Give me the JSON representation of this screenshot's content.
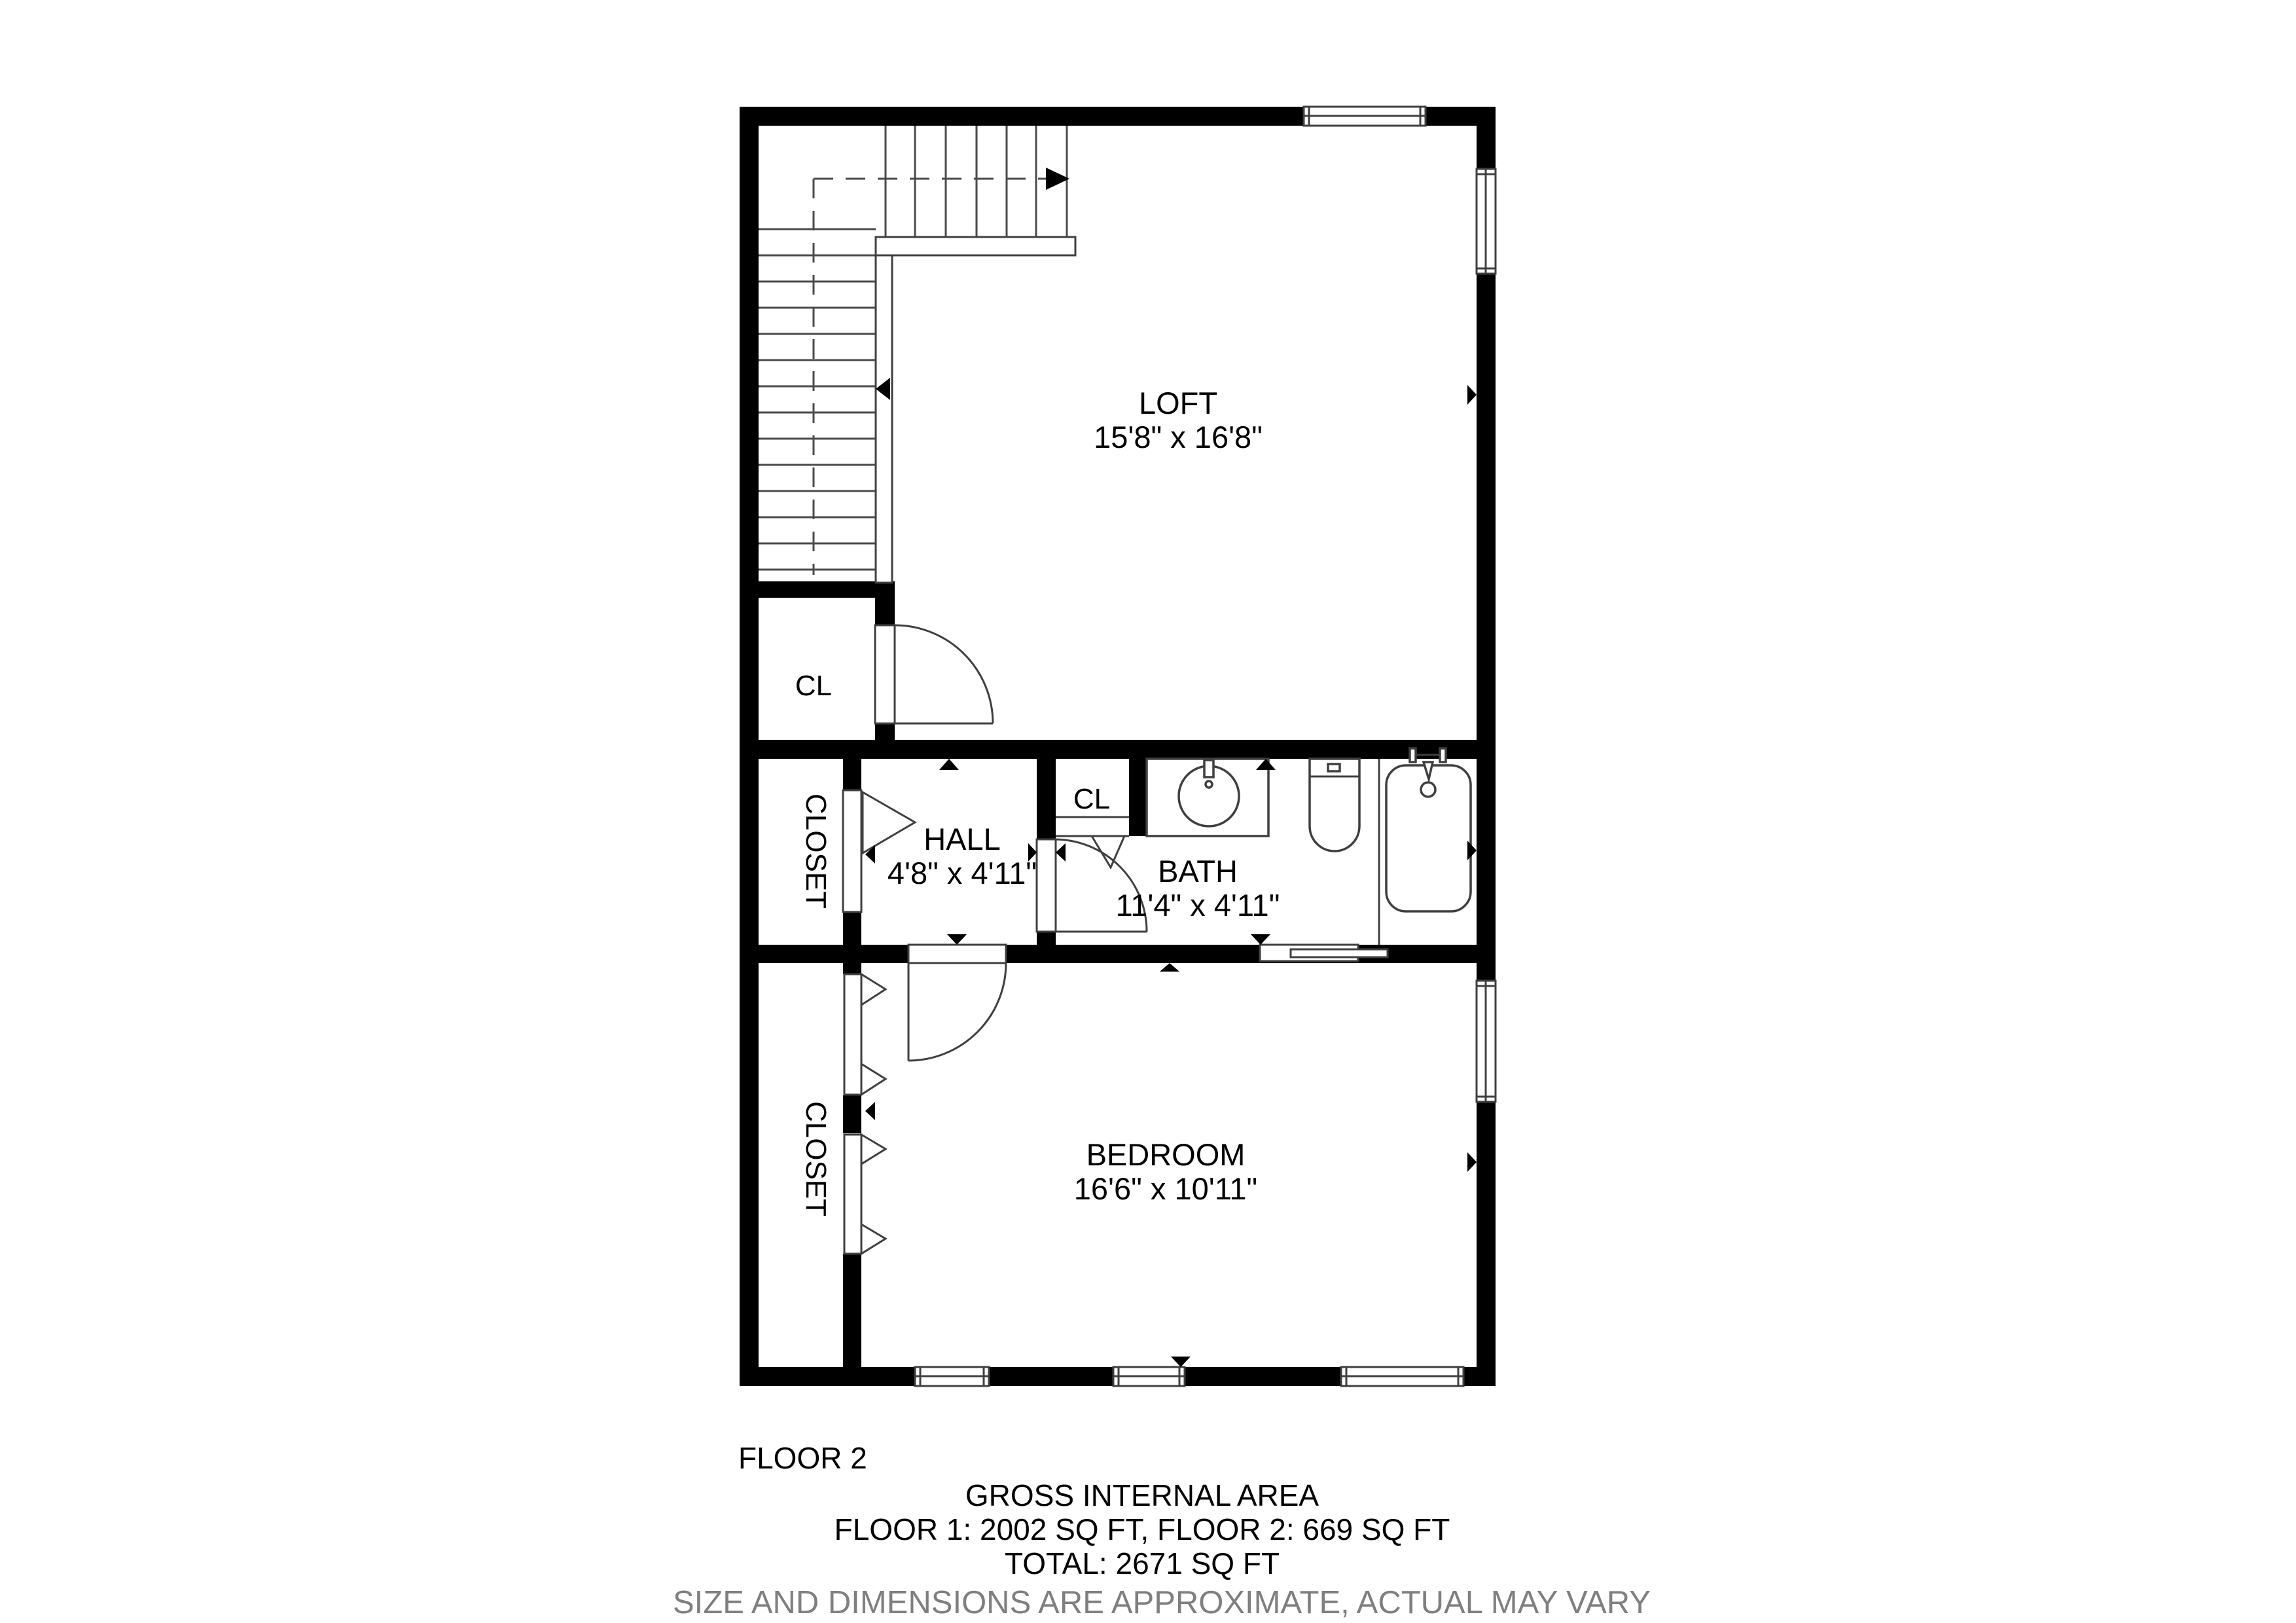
{
  "plan": {
    "rooms": {
      "loft": {
        "name": "LOFT",
        "dims": "15'8\" x 16'8\""
      },
      "hall": {
        "name": "HALL",
        "dims": "4'8\" x 4'11\""
      },
      "bath": {
        "name": "BATH",
        "dims": "11'4\" x 4'11\""
      },
      "bedroom": {
        "name": "BEDROOM",
        "dims": "16'6\" x 10'11\""
      },
      "closet_left": {
        "name": "CL"
      },
      "closet_bath": {
        "name": "CL"
      },
      "closet_hall": {
        "name": "CLOSET"
      },
      "closet_bedroom": {
        "name": "CLOSET"
      }
    },
    "footer": {
      "floor_label": "FLOOR 2",
      "gross_title": "GROSS INTERNAL AREA",
      "floors_line": "FLOOR 1: 2002 SQ FT, FLOOR 2: 669 SQ FT",
      "total_line": "TOTAL: 2671 SQ FT",
      "disclaimer": "SIZE AND DIMENSIONS ARE APPROXIMATE, ACTUAL MAY VARY"
    },
    "colors": {
      "wall": "#000000",
      "line": "#3f3f3f",
      "disclaimer_text": "#7f7f7f",
      "background": "#ffffff"
    }
  }
}
